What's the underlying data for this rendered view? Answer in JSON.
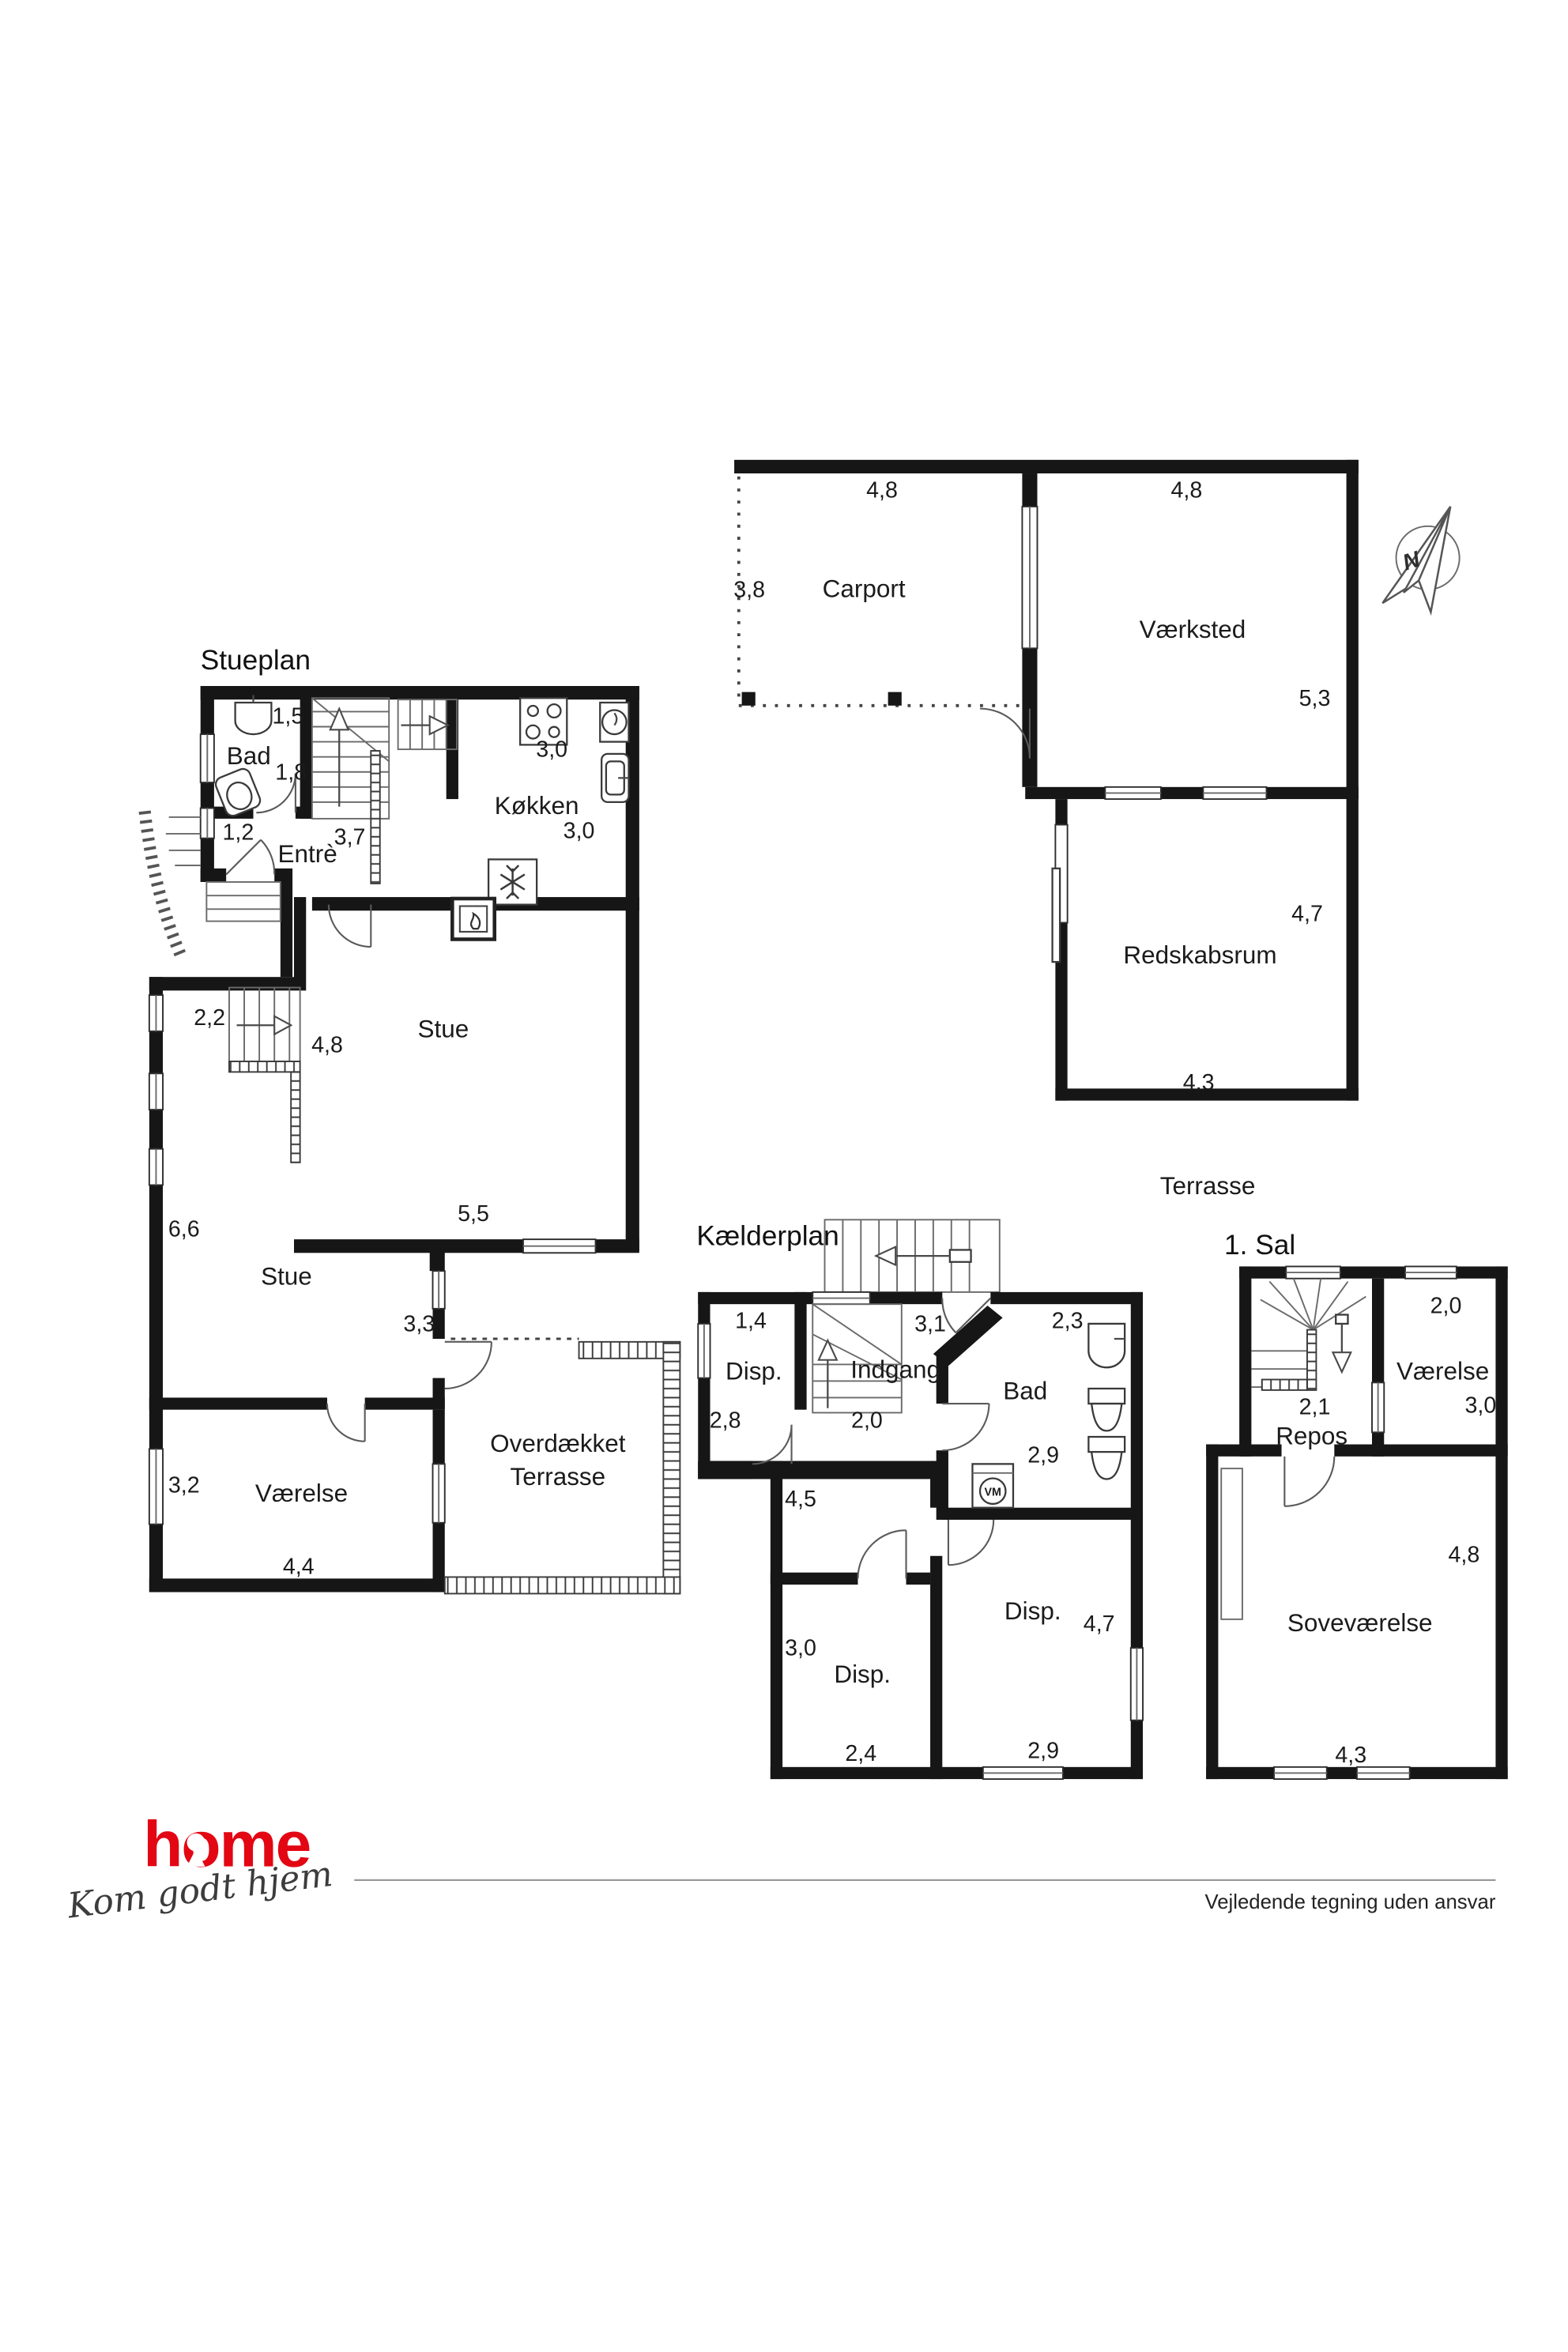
{
  "compass": {
    "label": "N"
  },
  "stueplan": {
    "title": "Stueplan",
    "bad": {
      "name": "Bad",
      "w": "1,5",
      "h": "1,8"
    },
    "entre": {
      "name": "Entrè",
      "window": "1,2",
      "stair": "3,7"
    },
    "koekken": {
      "name": "Køkken",
      "w": "3,0",
      "h": "3,0"
    },
    "stue_upper": {
      "name": "Stue",
      "h": "4,8",
      "w": "5,5"
    },
    "stue_lower": {
      "name": "Stue",
      "h": "6,6",
      "door": "3,3",
      "stair": "2,2"
    },
    "vaerelse": {
      "name": "Værelse",
      "h": "3,2",
      "w": "4,4"
    },
    "terrasse": {
      "line1": "Overdækket",
      "line2": "Terrasse"
    }
  },
  "outbuildings": {
    "carport": {
      "name": "Carport",
      "w": "4,8",
      "h": "3,8"
    },
    "vaerksted": {
      "name": "Værksted",
      "w": "4,8",
      "h": "5,3"
    },
    "redskabsrum": {
      "name": "Redskabsrum",
      "h": "4,7",
      "w": "4,3"
    },
    "terrasse_label": "Terrasse"
  },
  "kaelderplan": {
    "title": "Kælderplan",
    "disp1": {
      "name": "Disp.",
      "w": "1,4",
      "h": "2,8"
    },
    "indgang": {
      "name": "Indgang",
      "w": "3,1",
      "h": "2,0"
    },
    "bad": {
      "name": "Bad",
      "w": "2,3",
      "d": "2,9",
      "vm": "VM"
    },
    "hall_h": "4,5",
    "disp2": {
      "name": "Disp.",
      "h": "3,0",
      "w": "2,4"
    },
    "disp3": {
      "name": "Disp.",
      "h": "4,7",
      "w": "2,9"
    }
  },
  "first_floor": {
    "title": "1. Sal",
    "vaerelse": {
      "name": "Værelse",
      "w": "2,0",
      "h": "3,0"
    },
    "repos": {
      "name": "Repos",
      "w": "2,1"
    },
    "sovevaerelse": {
      "name": "Soveværelse",
      "h": "4,8",
      "w": "4,3"
    }
  },
  "footer": {
    "brand": "home",
    "tagline": "Kom godt hjem",
    "disclaimer": "Vejledende tegning uden ansvar",
    "brand_color": "#e30613"
  }
}
